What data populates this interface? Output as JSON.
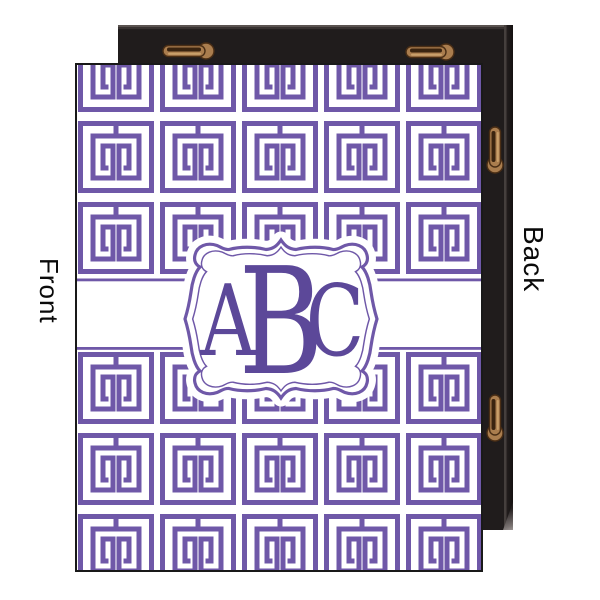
{
  "product_view": {
    "front": {
      "label": "Front",
      "monogram": {
        "left": "A",
        "center": "B",
        "right": "C"
      },
      "pattern_name": "greek-key-tiles",
      "pattern_color": "#6f58a8",
      "monogram_color": "#5c4899",
      "canvas_background": "#ffffff"
    },
    "back": {
      "label": "Back",
      "frame_color": "#201c1c",
      "hanger_color": "#aa7d4e",
      "hanger_slot_color": "#3a2410",
      "visible_hanger_count": 4
    }
  }
}
